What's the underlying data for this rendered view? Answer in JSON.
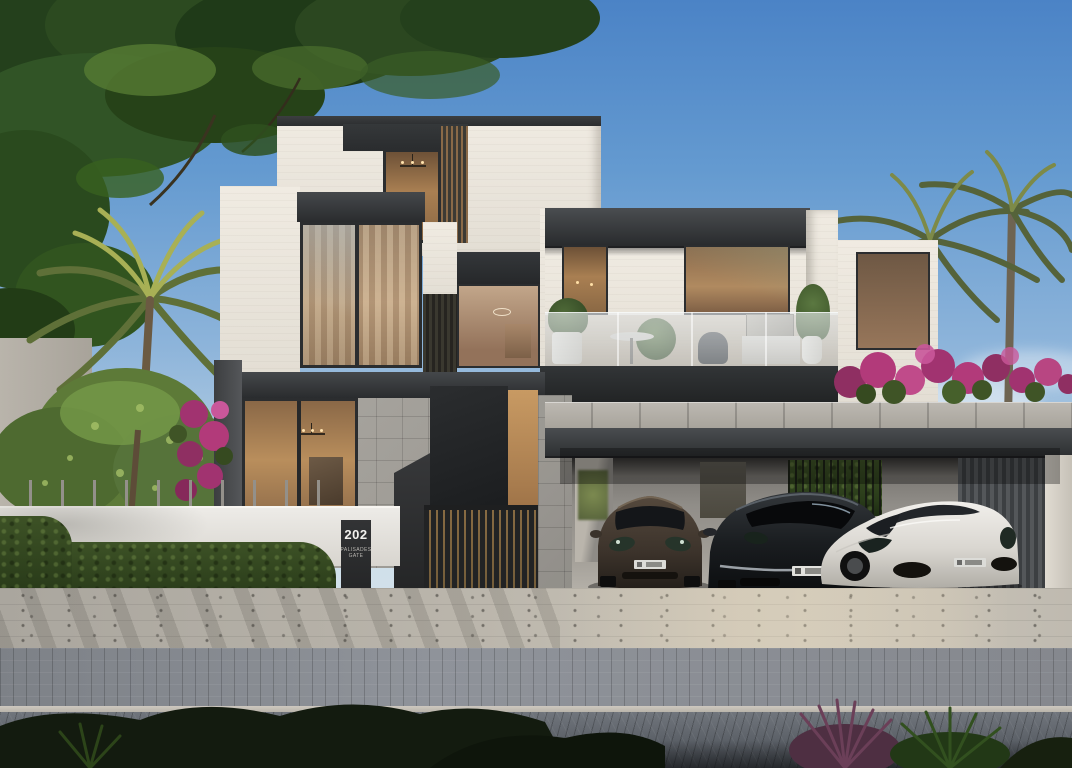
{
  "scene": {
    "type": "architectural-render",
    "description": "Photorealistic dusk rendering of a modern three-storey luxury villa with stacked white volumes, dark metal fascias, warm-lit floor-to-ceiling windows, a glass-railed balcony, an open carport with three cars, white picket fence with hedge, palm trees and bougainvillea, and a paved street in the foreground",
    "sign": {
      "number": "202",
      "line1": "PALISADES",
      "line2": "GATE"
    },
    "cars": [
      {
        "name": "dark-bronze-luxury-sedan",
        "color": "#453b33"
      },
      {
        "name": "black-luxury-sedan",
        "color": "#17191b"
      },
      {
        "name": "white-sports-car",
        "color": "#dcdad5"
      }
    ],
    "palette": {
      "sky_top": "#4b83c6",
      "sky_horizon": "#dde8ee",
      "wall_white": "#eae5dc",
      "fascia_dark": "#33363a",
      "stone_grey": "#a9a6a1",
      "interior_warm": "#a97f52",
      "hedge_green": "#2e4120",
      "palm_green": "#5c6b39",
      "bougainvillea_pink": "#b23a7a",
      "road_grey": "#6a6f76",
      "fence_white": "#eceae6"
    }
  }
}
